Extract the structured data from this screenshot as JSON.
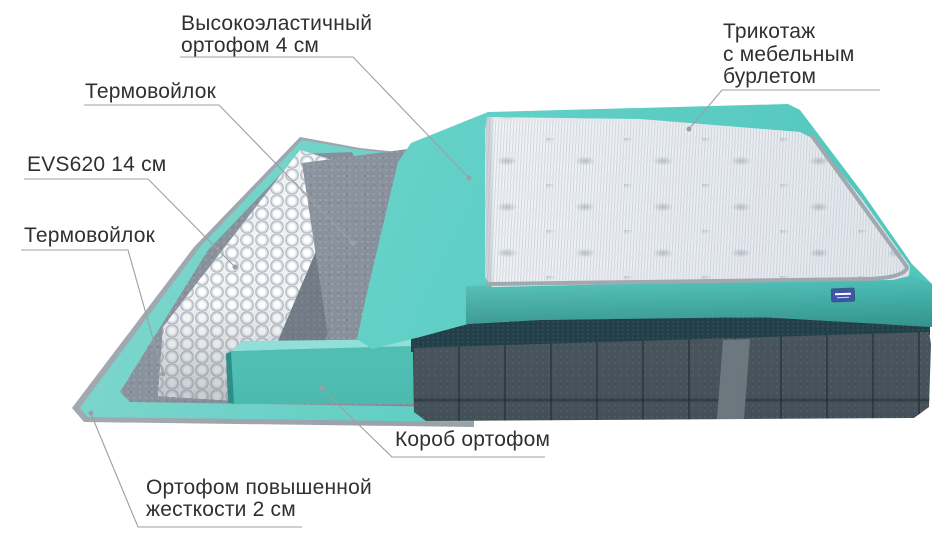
{
  "labels": {
    "elastic_foam": {
      "lines": [
        "Высокоэластичный",
        "ортофом 4 см"
      ]
    },
    "knit_cover": {
      "lines": [
        "Трикотаж",
        "с мебельным",
        "бурлетом"
      ]
    },
    "thermo_felt_upper": {
      "lines": [
        "Термовойлок"
      ]
    },
    "spring_unit": {
      "lines": [
        "EVS620 14 см"
      ]
    },
    "thermo_felt_lower": {
      "lines": [
        "Термовойлок"
      ]
    },
    "foam_box": {
      "lines": [
        "Короб ортофом"
      ]
    },
    "hard_foam_base": {
      "lines": [
        "Ортофом повышенной",
        "жесткости 2 см"
      ]
    }
  },
  "colors": {
    "teal": "#5ed0c6",
    "teal_deep": "#3aa79e",
    "felt_gray": "#858d98",
    "springs_white": "#eff1f4",
    "quilt_white": "#eef1f5",
    "mattress_gray": "#4f5b63",
    "rim_dark": "#23404a",
    "label_text": "#303030",
    "leader_gray": "#9aa0a4",
    "tag_blue": "#4053ab",
    "piping_gray": "#a0a8b0"
  }
}
